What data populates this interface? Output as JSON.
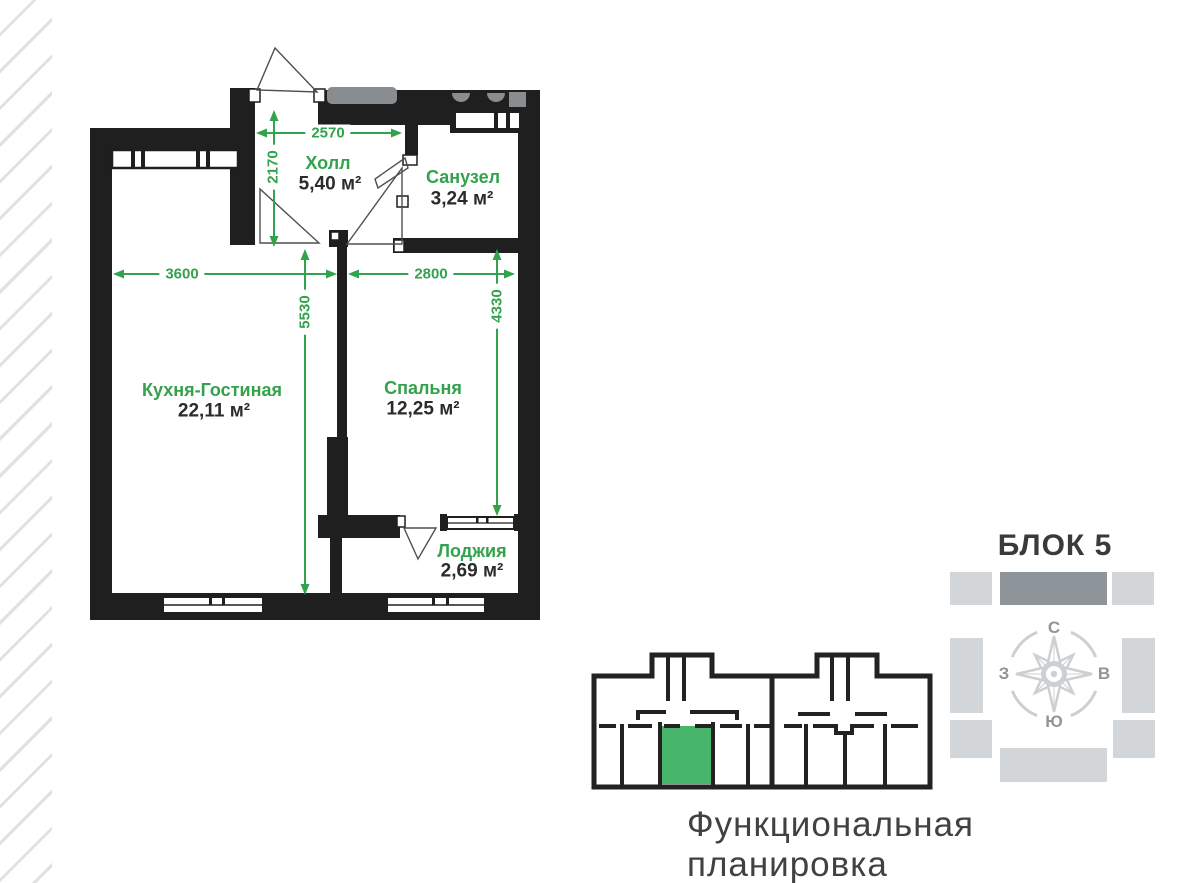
{
  "caption": "Функциональная планировка",
  "block_locator": {
    "title": "БЛОК 5",
    "compass": {
      "north": "С",
      "east": "В",
      "south": "Ю",
      "west": "З"
    }
  },
  "floor_plan": {
    "rooms": [
      {
        "id": "hall",
        "name": "Холл",
        "area": "5,40 м²"
      },
      {
        "id": "bathroom",
        "name": "Санузел",
        "area": "3,24 м²"
      },
      {
        "id": "kitchen-living",
        "name": "Кухня-Гостиная",
        "area": "22,11 м²"
      },
      {
        "id": "bedroom",
        "name": "Спальня",
        "area": "12,25 м²"
      },
      {
        "id": "loggia",
        "name": "Лоджия",
        "area": "2,69 м²"
      }
    ],
    "dimensions_mm": {
      "hall_width": "2570",
      "hall_depth": "2170",
      "kitchen_width": "3600",
      "bedroom_width": "2800",
      "kitchen_depth": "5530",
      "bedroom_depth": "4330"
    }
  },
  "colors": {
    "accent_green": "#33a24c",
    "unit_highlight_green": "#47b56c",
    "wall_black": "#1f1f1f",
    "block_gray": "#d3d6d9",
    "block_dark_gray": "#8e959a",
    "compass_gray": "#cdd0d2",
    "text_dark": "#3a3a3a"
  }
}
